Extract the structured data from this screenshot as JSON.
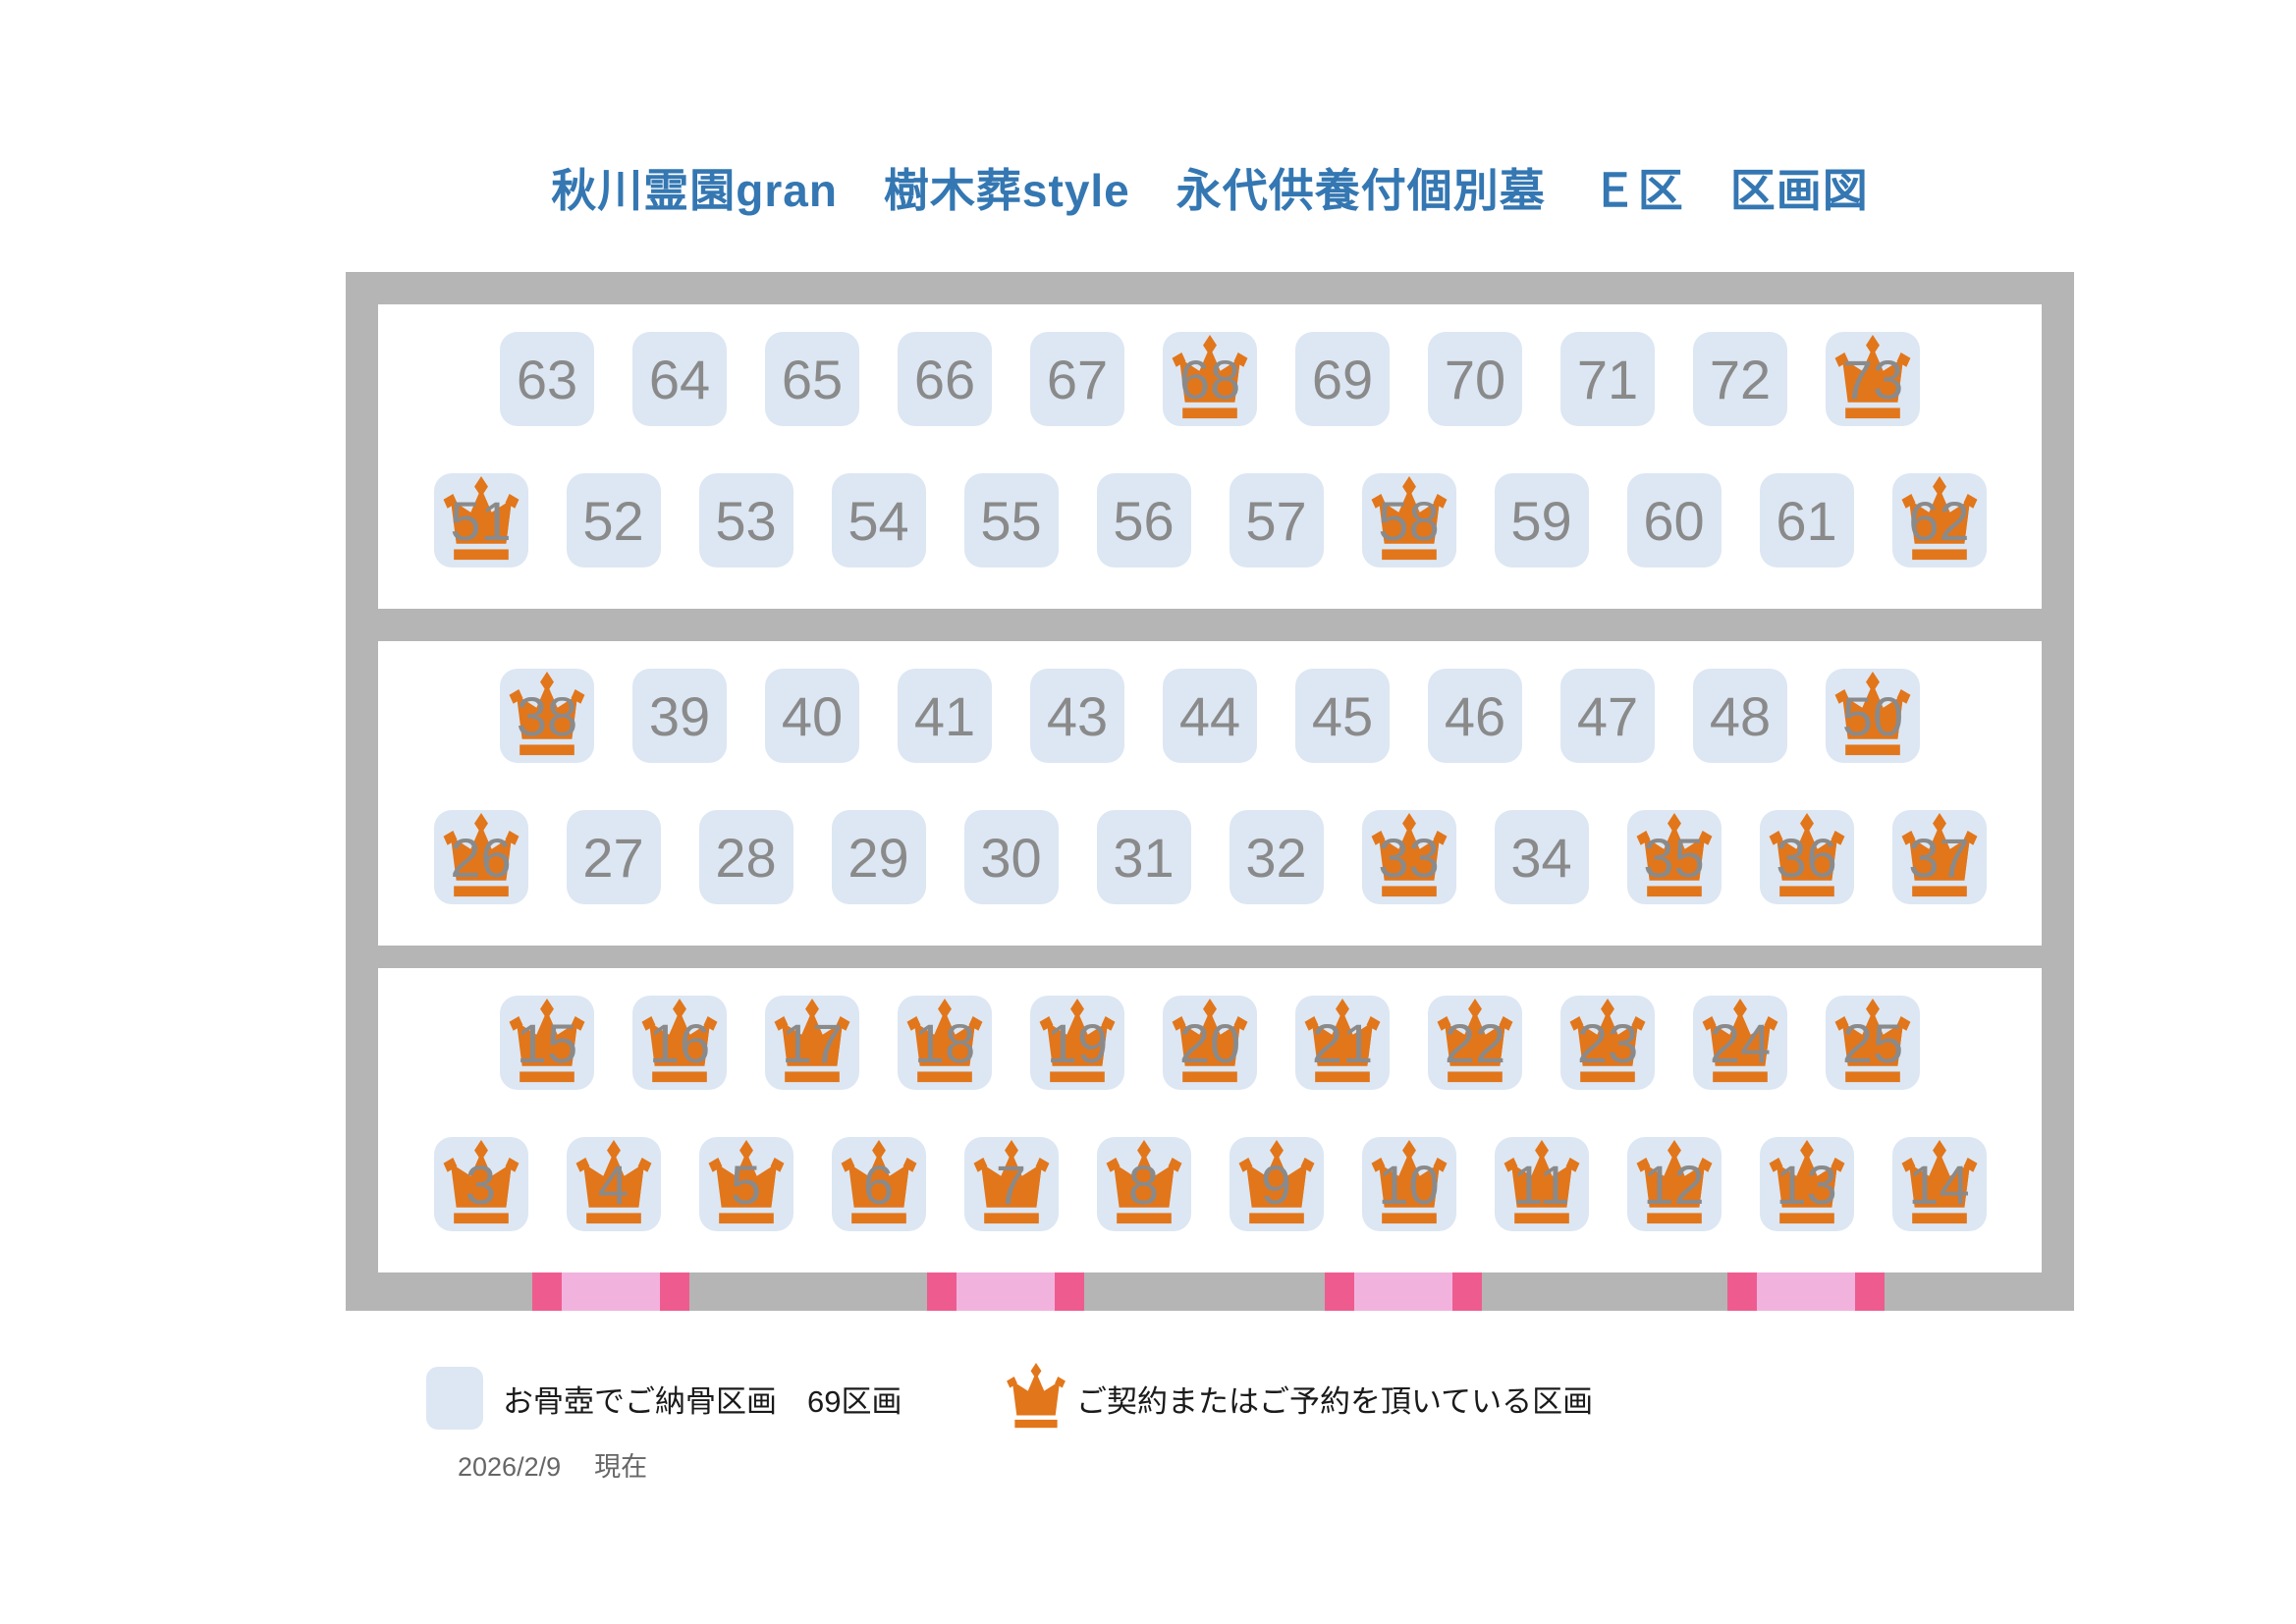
{
  "title": "秋川霊園gran　樹木葬style　永代供養付個別墓　Ｅ区　区画図",
  "colors": {
    "title": "#3477B2",
    "frame": "#B5B5B5",
    "cell": "#DCE7F3",
    "num": "#8A8A8A",
    "crown": "#E2761B",
    "pinkD": "#EE5C8F",
    "pinkL": "#F1B3DE"
  },
  "sections": [
    {
      "name": "top",
      "rows": [
        {
          "cells": [
            {
              "n": "63",
              "crown": false
            },
            {
              "n": "64",
              "crown": false
            },
            {
              "n": "65",
              "crown": false
            },
            {
              "n": "66",
              "crown": false
            },
            {
              "n": "67",
              "crown": false
            },
            {
              "n": "68",
              "crown": true
            },
            {
              "n": "69",
              "crown": false
            },
            {
              "n": "70",
              "crown": false
            },
            {
              "n": "71",
              "crown": false
            },
            {
              "n": "72",
              "crown": false
            },
            {
              "n": "73",
              "crown": true
            }
          ]
        },
        {
          "cells": [
            {
              "n": "51",
              "crown": true
            },
            {
              "n": "52",
              "crown": false
            },
            {
              "n": "53",
              "crown": false
            },
            {
              "n": "54",
              "crown": false
            },
            {
              "n": "55",
              "crown": false
            },
            {
              "n": "56",
              "crown": false
            },
            {
              "n": "57",
              "crown": false
            },
            {
              "n": "58",
              "crown": true
            },
            {
              "n": "59",
              "crown": false
            },
            {
              "n": "60",
              "crown": false
            },
            {
              "n": "61",
              "crown": false
            },
            {
              "n": "62",
              "crown": true
            }
          ]
        }
      ]
    },
    {
      "name": "middle",
      "rows": [
        {
          "cells": [
            {
              "n": "38",
              "crown": true
            },
            {
              "n": "39",
              "crown": false
            },
            {
              "n": "40",
              "crown": false
            },
            {
              "n": "41",
              "crown": false
            },
            {
              "n": "43",
              "crown": false
            },
            {
              "n": "44",
              "crown": false
            },
            {
              "n": "45",
              "crown": false
            },
            {
              "n": "46",
              "crown": false
            },
            {
              "n": "47",
              "crown": false
            },
            {
              "n": "48",
              "crown": false
            },
            {
              "n": "50",
              "crown": true
            }
          ]
        },
        {
          "cells": [
            {
              "n": "26",
              "crown": true
            },
            {
              "n": "27",
              "crown": false
            },
            {
              "n": "28",
              "crown": false
            },
            {
              "n": "29",
              "crown": false
            },
            {
              "n": "30",
              "crown": false
            },
            {
              "n": "31",
              "crown": false
            },
            {
              "n": "32",
              "crown": false
            },
            {
              "n": "33",
              "crown": true
            },
            {
              "n": "34",
              "crown": false
            },
            {
              "n": "35",
              "crown": true
            },
            {
              "n": "36",
              "crown": true
            },
            {
              "n": "37",
              "crown": true
            }
          ]
        }
      ]
    },
    {
      "name": "bottom",
      "rows": [
        {
          "cells": [
            {
              "n": "15",
              "crown": true
            },
            {
              "n": "16",
              "crown": true
            },
            {
              "n": "17",
              "crown": true
            },
            {
              "n": "18",
              "crown": true
            },
            {
              "n": "19",
              "crown": true
            },
            {
              "n": "20",
              "crown": true
            },
            {
              "n": "21",
              "crown": true
            },
            {
              "n": "22",
              "crown": true
            },
            {
              "n": "23",
              "crown": true
            },
            {
              "n": "24",
              "crown": true
            },
            {
              "n": "25",
              "crown": true
            }
          ]
        },
        {
          "cells": [
            {
              "n": "3",
              "crown": true
            },
            {
              "n": "4",
              "crown": true
            },
            {
              "n": "5",
              "crown": true
            },
            {
              "n": "6",
              "crown": true
            },
            {
              "n": "7",
              "crown": true
            },
            {
              "n": "8",
              "crown": true
            },
            {
              "n": "9",
              "crown": true
            },
            {
              "n": "10",
              "crown": true
            },
            {
              "n": "11",
              "crown": true
            },
            {
              "n": "12",
              "crown": true
            },
            {
              "n": "13",
              "crown": true
            },
            {
              "n": "14",
              "crown": true
            }
          ]
        }
      ]
    }
  ],
  "legend": {
    "vacant_label": "お骨壺でご納骨区画　69区画",
    "reserved_label": "ご契約またはご予約を頂いている区画"
  },
  "footer": {
    "date": "2026/2/9",
    "suffix": "現在"
  }
}
